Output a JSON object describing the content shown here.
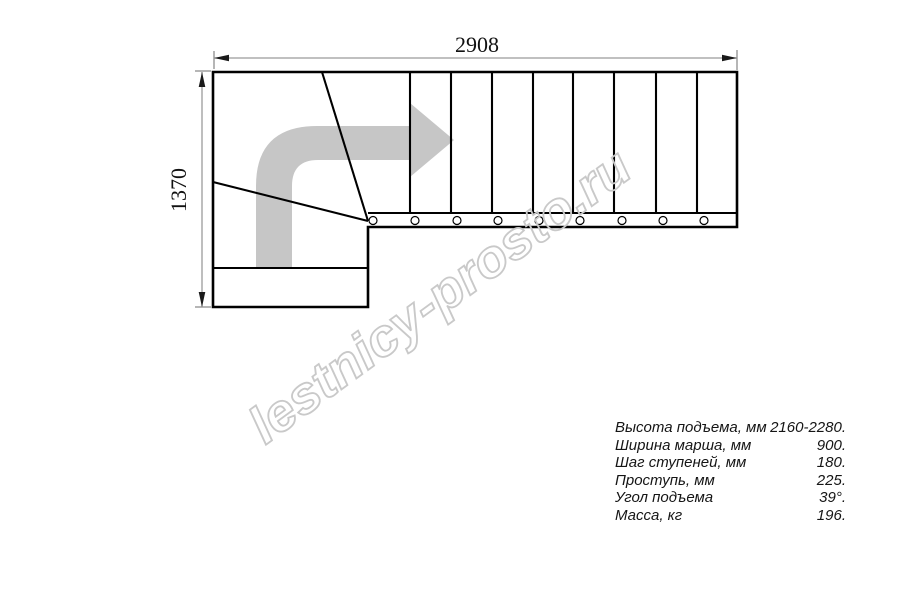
{
  "drawing": {
    "width_label": "2908",
    "height_label": "1370",
    "watermark": "lestnicy-prosto.ru",
    "colors": {
      "line": "#000000",
      "dimension_line": "#9b9b9b",
      "arrow_fill": "#c6c6c6",
      "watermark_stroke": "#c9c9c9"
    }
  },
  "specs": {
    "rows": [
      {
        "label": "Высота подъема, мм",
        "value": "2160-2280."
      },
      {
        "label": "Ширина марша, мм",
        "value": "900."
      },
      {
        "label": "Шаг ступеней, мм",
        "value": "180."
      },
      {
        "label": "Проступь, мм",
        "value": "225."
      },
      {
        "label": "Угол подъема",
        "value": "39°."
      },
      {
        "label": "Масса, кг",
        "value": "196."
      }
    ]
  }
}
